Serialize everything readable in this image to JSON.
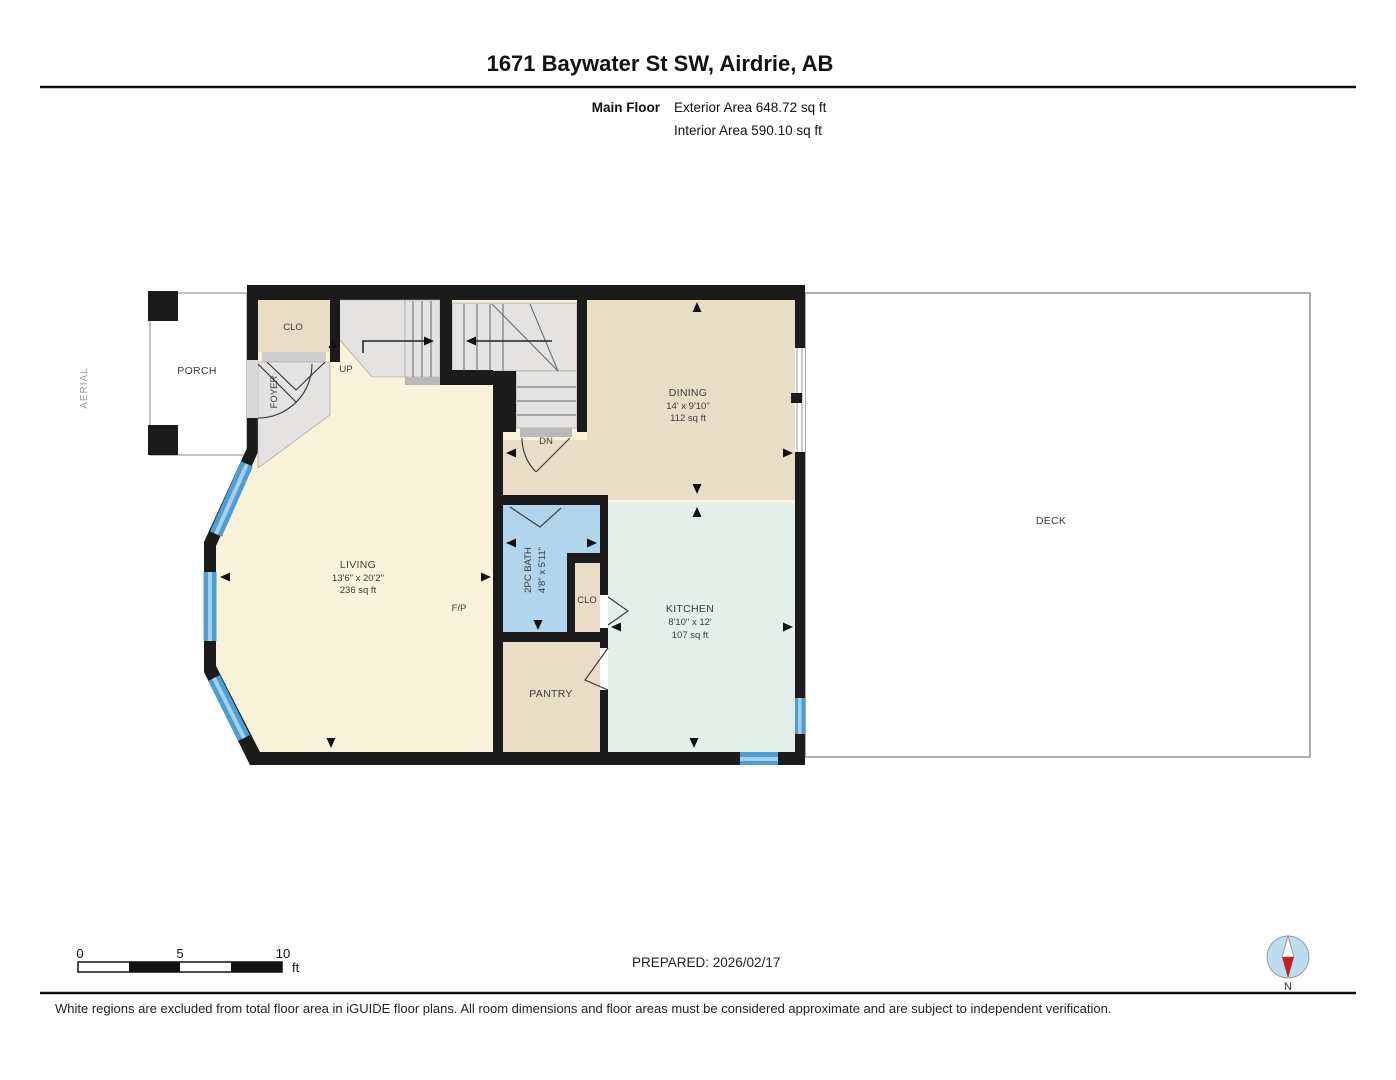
{
  "header": {
    "title": "1671 Baywater St SW, Airdrie, AB",
    "floor_label": "Main Floor",
    "exterior_area": "Exterior Area 648.72 sq ft",
    "interior_area": "Interior Area 590.10 sq ft"
  },
  "plan": {
    "side_label": "AERIAL",
    "rooms": {
      "porch": {
        "label": "PORCH"
      },
      "entry_closet": {
        "label": "CLO"
      },
      "foyer": {
        "label": "FOYER"
      },
      "stairs_up": {
        "label": "UP"
      },
      "stairs_down": {
        "label": "DN"
      },
      "dining": {
        "label": "DINING",
        "dims": "14' x 9'10\"",
        "area": "112 sq ft"
      },
      "deck": {
        "label": "DECK"
      },
      "living": {
        "label": "LIVING",
        "dims": "13'6\" x 20'2\"",
        "area": "236 sq ft"
      },
      "fireplace": {
        "label": "F/P"
      },
      "bath": {
        "label": "2PC BATH",
        "dims": "4'8\" x 5'11\""
      },
      "kitchen_closet": {
        "label": "CLO"
      },
      "kitchen": {
        "label": "KITCHEN",
        "dims": "8'10\" x 12'",
        "area": "107 sq ft"
      },
      "pantry": {
        "label": "PANTRY"
      }
    }
  },
  "scale_bar": {
    "ticks": [
      "0",
      "5",
      "10"
    ],
    "unit": "ft"
  },
  "footer": {
    "prepared": "PREPARED: 2026/02/17",
    "compass_label": "N",
    "disclaimer": "White regions are excluded from total floor area in iGUIDE floor plans. All room dimensions and floor areas must be considered approximate and are subject to independent verification."
  },
  "colors": {
    "wall": "#1b1b1b",
    "living_fill": "#FAF3DB",
    "tan_fill": "#EADDC8",
    "stair_gray": "#E4E3E1",
    "bath_fill": "#AFD4EC",
    "kitchen_fill": "#E3EFE8",
    "window_blue": "#4D9FD3",
    "compass_red": "#C52025"
  }
}
